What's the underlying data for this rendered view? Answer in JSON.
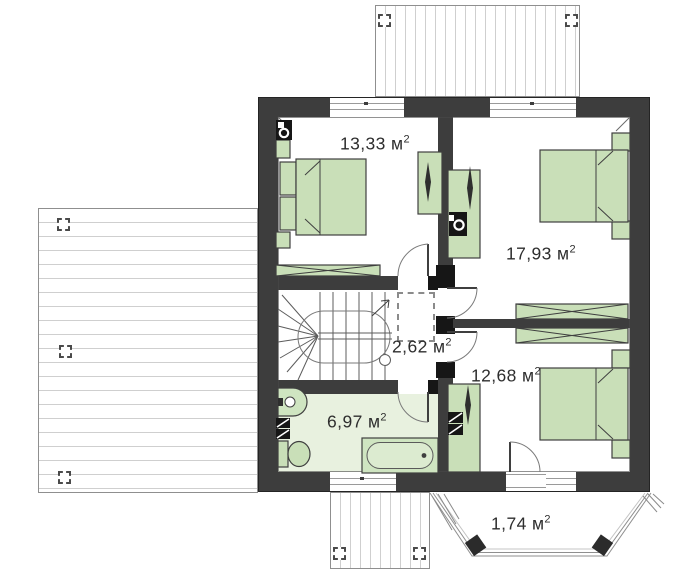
{
  "plan": {
    "unit": " м",
    "sup": "2",
    "rooms": [
      {
        "id": "bedroom-top-left",
        "area": "13,33"
      },
      {
        "id": "bedroom-right",
        "area": "17,93"
      },
      {
        "id": "hall",
        "area": "2,62"
      },
      {
        "id": "bedroom-bottom-right",
        "area": "12,68"
      },
      {
        "id": "bathroom",
        "area": "6,97"
      },
      {
        "id": "bay-balcony",
        "area": "1,74"
      }
    ],
    "colors": {
      "wall": "#3d3d3d",
      "furniture": "#c9dfb8",
      "bathroom_floor": "#e8f1df",
      "accent_black": "#161616"
    }
  }
}
